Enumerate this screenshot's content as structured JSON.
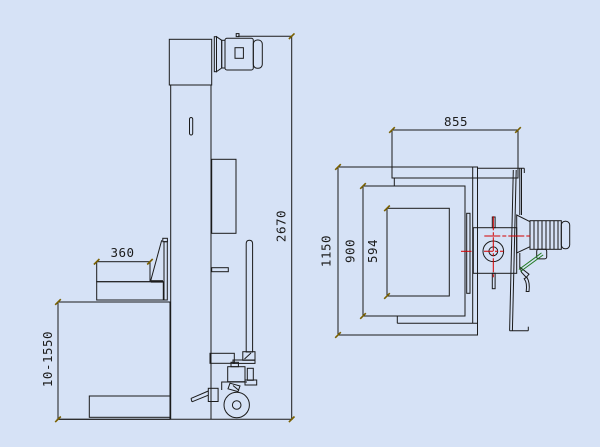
{
  "drawing": {
    "type": "engineering-cad-drawing",
    "subject": "lift-stacker-machine-two-views",
    "background_color": "#d6e2f6",
    "line_color": "#1b1b1b",
    "centerline_color": "#d40000",
    "leader_line_color": "#1f7a1f",
    "dimension_tick_color": "#7a6000",
    "dimension_text_color": "#1c1c1c",
    "views": {
      "side_view": {
        "name": "side-elevation-view",
        "dimensions": [
          {
            "id": "fork-length",
            "label": "360",
            "orientation": "horizontal"
          },
          {
            "id": "overall-height",
            "label": "2670",
            "orientation": "vertical"
          },
          {
            "id": "lift-height-range",
            "label": "10-1550",
            "orientation": "vertical"
          }
        ]
      },
      "top_view": {
        "name": "plan-view",
        "dimensions": [
          {
            "id": "head-frame-width",
            "label": "855",
            "orientation": "horizontal"
          },
          {
            "id": "overall-depth",
            "label": "1150",
            "orientation": "vertical"
          },
          {
            "id": "body-depth",
            "label": "900",
            "orientation": "vertical"
          },
          {
            "id": "platform-depth",
            "label": "594",
            "orientation": "vertical"
          }
        ]
      }
    }
  }
}
